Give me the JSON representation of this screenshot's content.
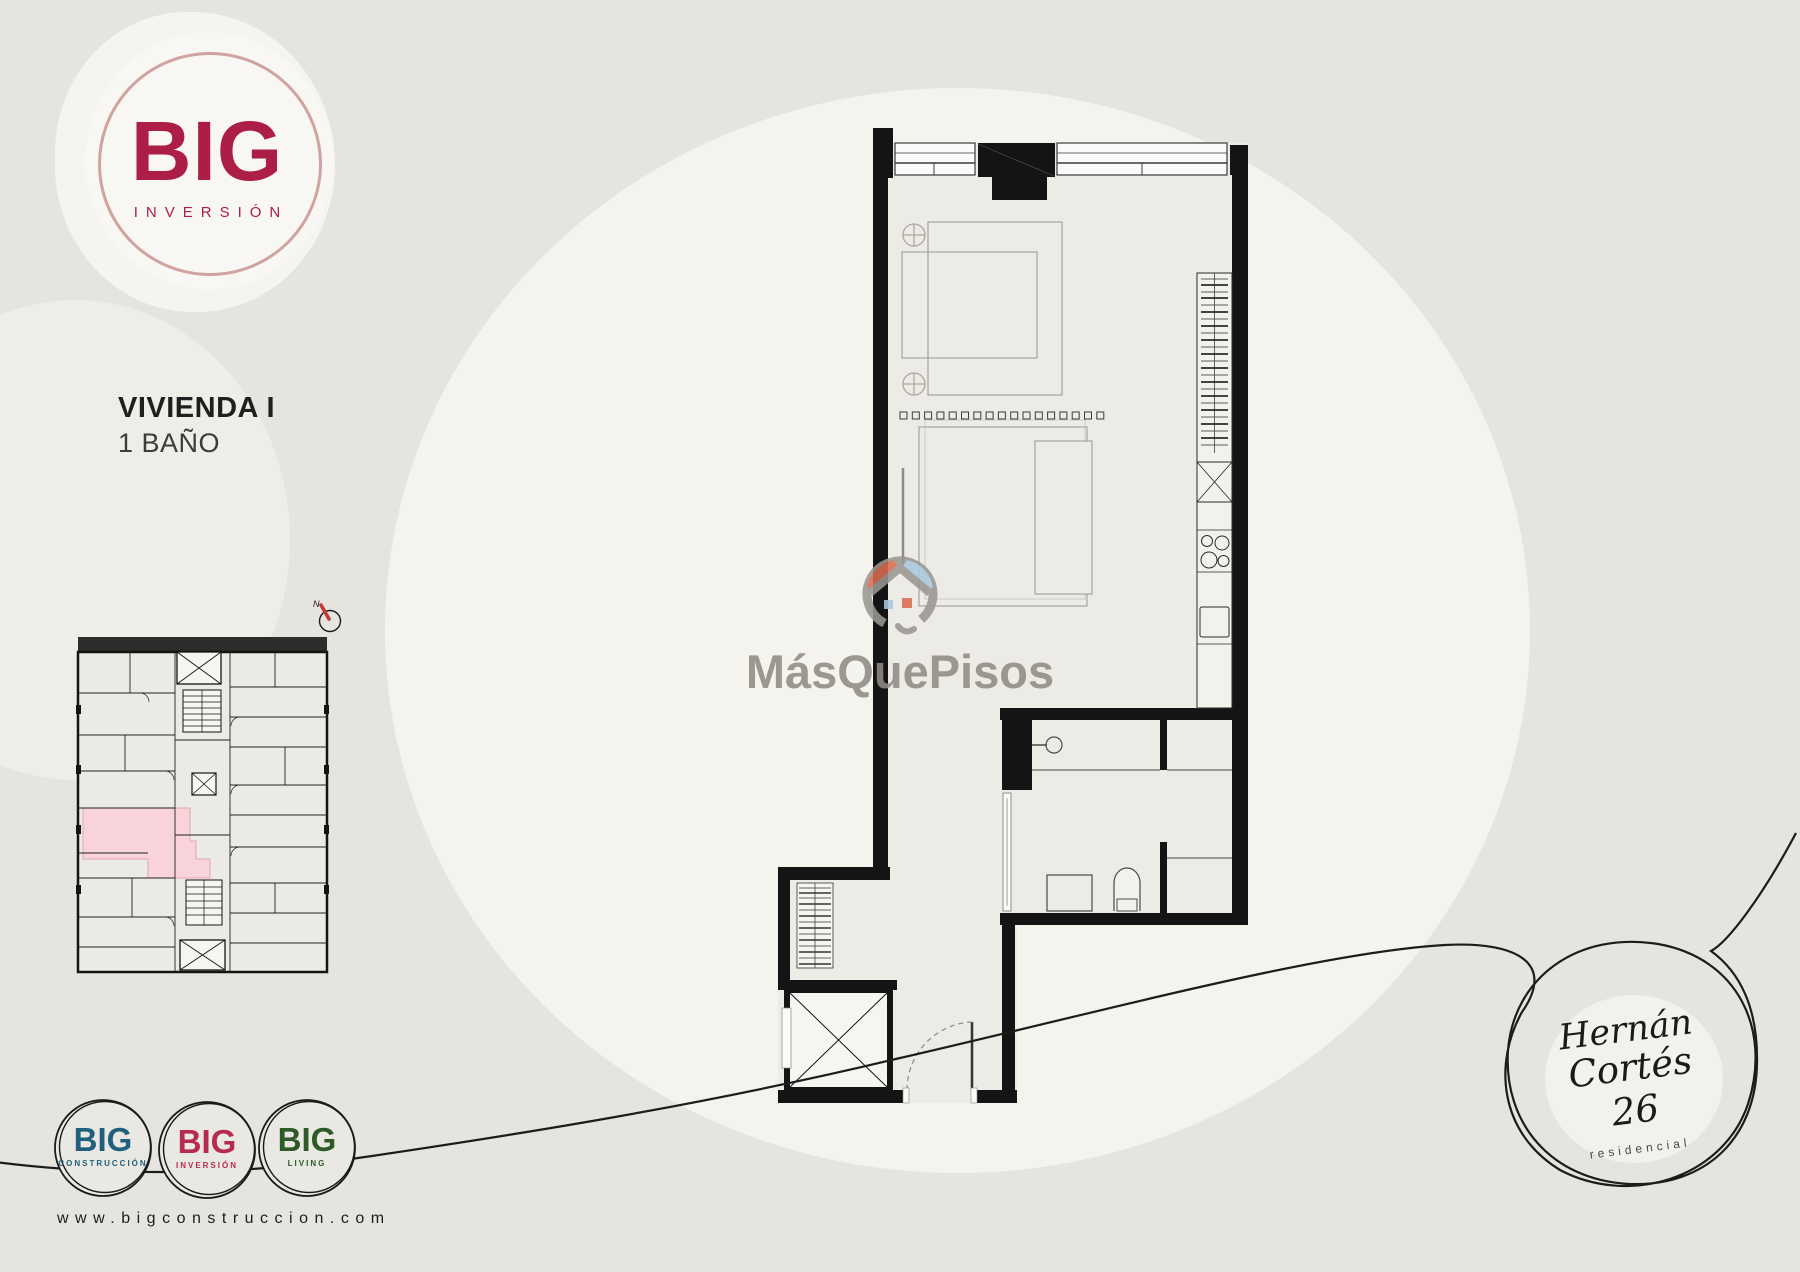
{
  "brand": {
    "name": "BIG",
    "sub": "INVERSIÓN",
    "color": "#AD1E46",
    "ring_color": "#D0A3A0"
  },
  "unit": {
    "title": "VIVIENDA I",
    "subtitle": "1 BAÑO"
  },
  "compass": {
    "label": "N",
    "needle_color": "#C6373B"
  },
  "overview_plan": {
    "highlight_unit_color": "#F8D3D9",
    "wall_color": "#141414"
  },
  "main_plan": {
    "wall_color": "#141414",
    "floor_color": "#EDEBE5",
    "furniture_color": "#ABA8A2",
    "fixture_color": "#4A4A4A"
  },
  "watermark": {
    "text": "MásQuePisos",
    "text_color": "#8F8C86",
    "icon": "masquepisos-house-icon",
    "icon_colors": {
      "ring": "#9A9792",
      "left_wedge": "#D96C4F",
      "right_wedge": "#A9C7DF"
    }
  },
  "footer": {
    "logos": [
      {
        "name": "BIG",
        "sub": "CONSTRUCCIÓN",
        "color": "#20607E"
      },
      {
        "name": "BIG",
        "sub": "INVERSIÓN",
        "color": "#B62A50"
      },
      {
        "name": "BIG",
        "sub": "LIVING",
        "color": "#2D5A27"
      }
    ],
    "website": "www.bigconstruccion.com"
  },
  "residential_logo": {
    "line1": "Hernán",
    "line2": "Cortés 26",
    "sub": "residencial"
  }
}
